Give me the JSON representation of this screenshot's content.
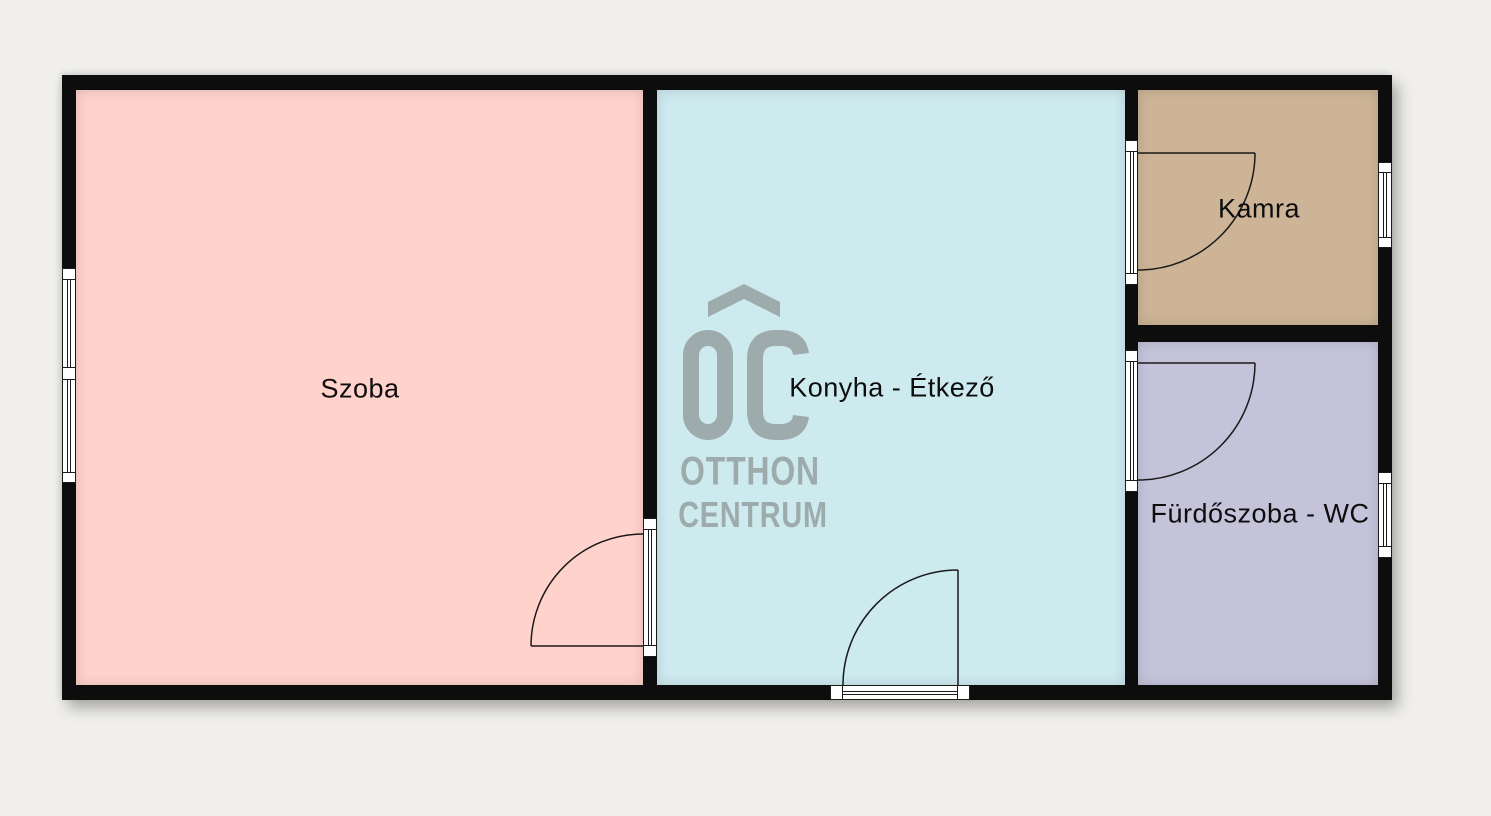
{
  "floorplan": {
    "background_color": "#f0efeb",
    "wall_color": "#0d0d0d",
    "label_color": "#0d0d0d",
    "rooms": [
      {
        "name": "szoba",
        "label": "Szoba",
        "color": "#ffd2cc"
      },
      {
        "name": "konyha-etkezo",
        "label": "Konyha - Étkező",
        "color": "#cdeaef"
      },
      {
        "name": "kamra",
        "label": "Kamra",
        "color": "#cdb496"
      },
      {
        "name": "furdoszoba-wc",
        "label": "Fürdőszoba - WC",
        "color": "#c4c3da"
      }
    ],
    "watermark": {
      "monogram": "OC",
      "line1": "OTTHON",
      "line2": "CENTRUM",
      "color": "#9dabad"
    }
  }
}
